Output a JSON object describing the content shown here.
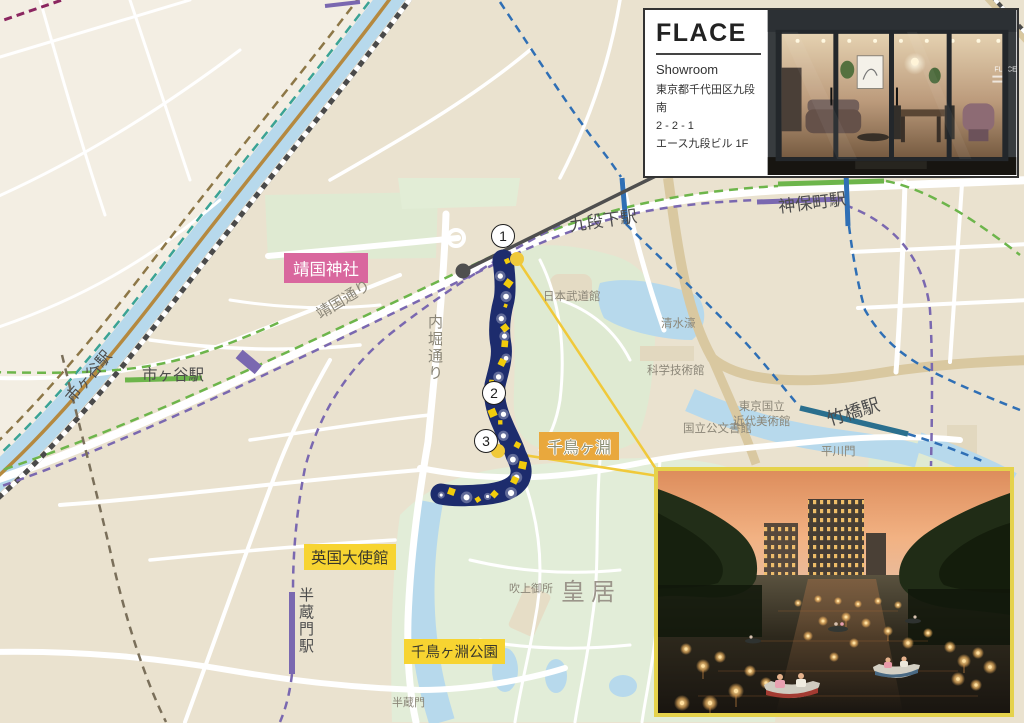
{
  "showroom_card": {
    "brand": "FLACE",
    "label": "Showroom",
    "address_line1": "東京都千代田区九段南",
    "address_line2": "2 - 2 - 1",
    "address_line3": "エース九段ビル 1F",
    "window_text": "FLACE"
  },
  "map": {
    "station_labels": {
      "ichigaya_rail": "市ヶ谷駅",
      "ichigaya": "市ヶ谷駅",
      "kudanshita": "九段下駅",
      "jimbocho": "神保町駅",
      "takebashi": "竹橋駅",
      "hanzomon": "半蔵門駅"
    },
    "place_labels": {
      "yasukuni_shrine": "靖国神社",
      "yasukuni_dori": "靖国通り",
      "uchibori_dori": "内堀通り",
      "nippon_budokan": "日本武道館",
      "shimizubori": "清水濠",
      "science_museum": "科学技術館",
      "momat_line1": "東京国立",
      "momat_line2": "近代美術館",
      "national_archives": "国立公文書館",
      "hirakawamon": "平川門",
      "chidorigafuchi": "千鳥ヶ淵",
      "british_embassy": "英国大使館",
      "imperial_palace": "皇居",
      "fukiage_gosho": "吹上御所",
      "chidorigafuchi_park": "千鳥ヶ淵公園",
      "hanzomon_gate": "半蔵門"
    },
    "route_markers": {
      "m1": "1",
      "m2": "2",
      "m3": "3"
    },
    "colors": {
      "moat_highlight": "#1d2c6d",
      "sparkle_yellow": "#f2cc0c",
      "route_accent_yellow": "#f0c93a",
      "route_gray": "#4f4f4f",
      "shrine_label_bg": "#d9679e",
      "highlight_label_bg": "#f7d431",
      "chidorigafuchi_label_bg": "#e9a83d",
      "photo_border": "#e5d24b",
      "water": "#b7d9ec",
      "park_green": "#e0ecd4",
      "rail_gold": "#b5893f",
      "metro_green": "#6db54b",
      "metro_purple": "#7a68b0",
      "metro_blue": "#2f6fb5",
      "metro_teal_dash": "#3aa395",
      "tozai_station_teal": "#2a6f8e"
    }
  }
}
